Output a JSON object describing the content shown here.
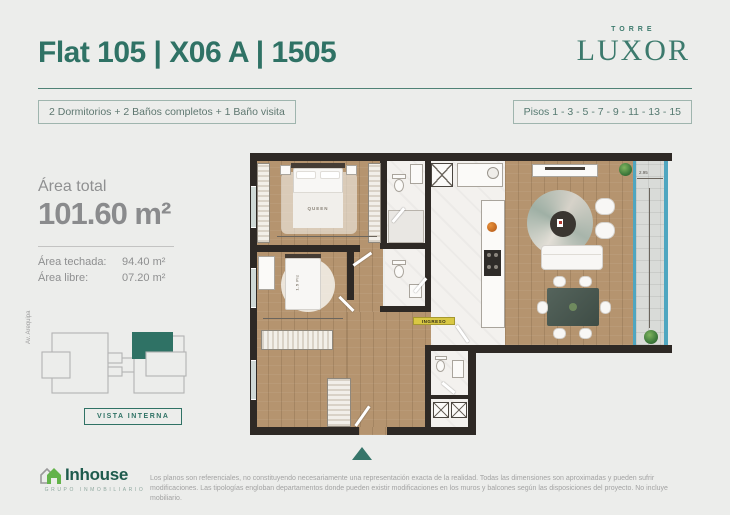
{
  "header": {
    "title": "Flat 105 | X06 A | 1505",
    "brand": {
      "top": "TORRE",
      "name": "LUXOR"
    },
    "badge_left": "2 Dormitorios + 2 Baños completos + 1 Baño visita",
    "badge_right": "Pisos 1 - 3 - 5 - 7 - 9 - 11 - 13 - 15"
  },
  "area": {
    "label": "Área total",
    "total": "101.60 m²",
    "techada_label": "Área techada:",
    "techada_value": "94.40 m²",
    "libre_label": "Área libre:",
    "libre_value": "07.20 m²"
  },
  "keyplan": {
    "street": "Av. Arequipa",
    "badge": "VISTA INTERNA"
  },
  "plan": {
    "labels": {
      "queen": "QUEEN",
      "bed2": "1.5 Plz",
      "entrance": "INGRESO",
      "dim_balcony": "2.95"
    }
  },
  "footer": {
    "logo_name": "Inhouse",
    "logo_subtitle": "GRUPO INMOBILIARIO",
    "disclaimer": "Los planos son referenciales, no constituyendo necesariamente una representación exacta de la realidad. Todas las dimensiones son aproximadas y pueden sufrir modificaciones. Las tipologías engloban departamentos donde pueden existir modificaciones en los muros y balcones según las disposiciones del proyecto. No incluye mobiliario."
  },
  "colors": {
    "teal": "#2F7265",
    "wall": "#2E2925",
    "wood": "#B5946F",
    "glass": "#4FA6C0",
    "background": "#ECEDEB",
    "accent_green": "#63B34A",
    "label_yellow": "#D9C843"
  }
}
